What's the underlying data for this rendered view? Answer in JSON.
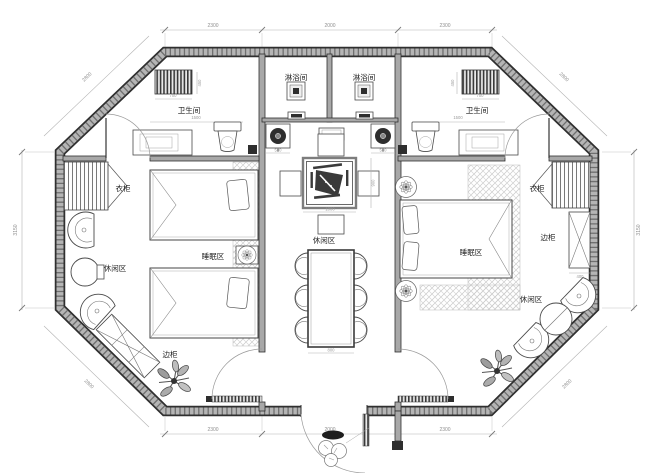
{
  "labels": {
    "shower_room": "淋浴间",
    "bathroom": "卫生间",
    "wardrobe": "衣柜",
    "sleeping_area": "睡眠区",
    "leisure_area": "休闲区",
    "side_cabinet": "边柜"
  },
  "dimensions": {
    "top": [
      "2300",
      "2000",
      "2300"
    ],
    "bottom": [
      "2300",
      "2000",
      "2300"
    ],
    "side": "3150",
    "diagonal": "2800",
    "radiator_width": "700",
    "radiator_depth": "450",
    "toilet_wall": "1500",
    "basin": "500",
    "tea_table_width": "1000",
    "tea_table_depth": "900",
    "dining_table_width": "800",
    "cabinet_depth": "400"
  },
  "colors": {
    "line": "#2f2f2f",
    "wall_core": "#b5b5b5",
    "dim_text": "#8f8f8f",
    "hatch": "#c9c9c9"
  }
}
